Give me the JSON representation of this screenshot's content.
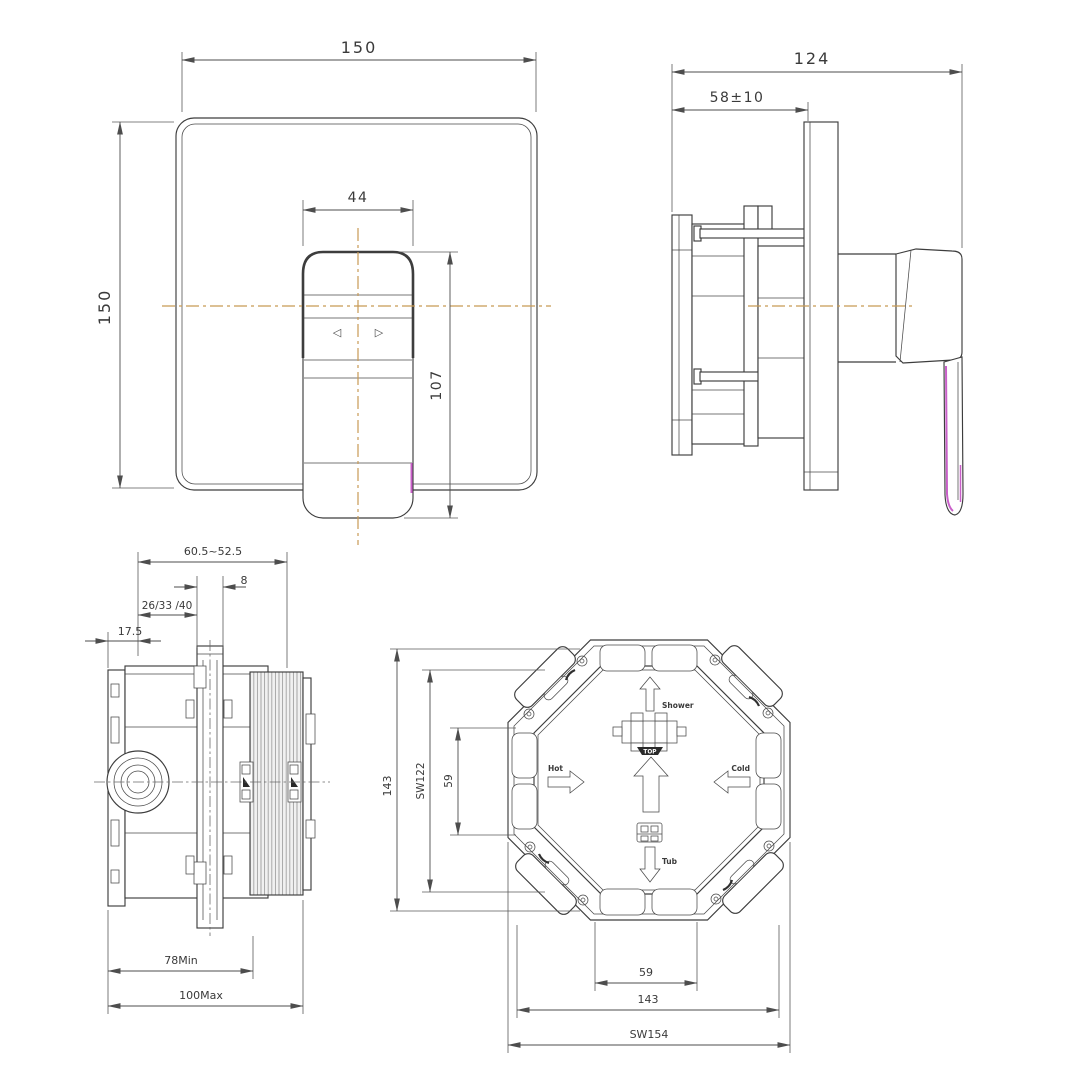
{
  "title": "concealed-shower-mixer-installation-drawing",
  "colors": {
    "background": "#ffffff",
    "line": "#3d3d3d",
    "centerline": "#c89a55",
    "accent": "#c95fc9"
  },
  "views": {
    "front": {
      "dim_width": "150",
      "dim_height": "150",
      "dim_handle_width": "44",
      "dim_handle_height": "107",
      "handle_left_glyph": "◁",
      "handle_right_glyph": "▷"
    },
    "side": {
      "dim_total_depth": "124",
      "dim_wall_depth": "58±10"
    },
    "valve_side": {
      "dim_adjust_range": "60.5~52.5",
      "dim_plate_thickness": "8",
      "dim_depth_options": "26/33 /40",
      "dim_offset": "17.5",
      "dim_min_depth": "78Min",
      "dim_max_depth": "100Max"
    },
    "valve_front": {
      "dim_height": "143",
      "dim_sw_vertical": "SW122",
      "dim_port_spacing_v": "59",
      "dim_port_spacing_h": "59",
      "dim_width": "143",
      "dim_sw_horizontal": "SW154",
      "label_shower": "Shower",
      "label_top": "TOP",
      "label_hot": "Hot",
      "label_cold": "Cold",
      "label_tub": "Tub"
    }
  }
}
